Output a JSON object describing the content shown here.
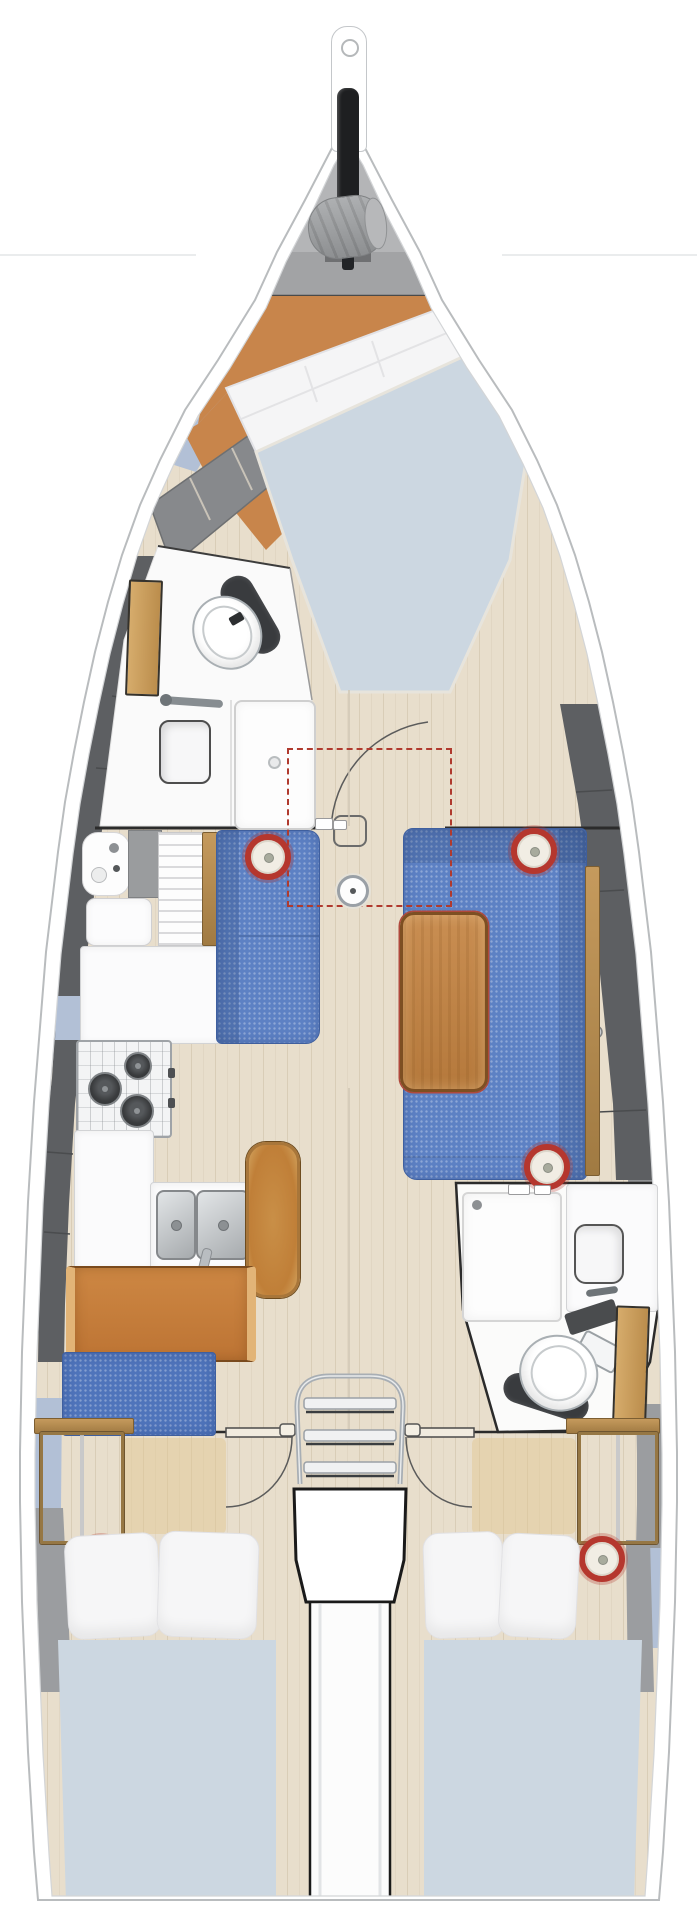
{
  "diagram": {
    "title": "Sailing yacht interior layout plan, top-down, bow up",
    "orientation": "bow-up",
    "areas": [
      {
        "id": "bow-locker",
        "label": "Bow anchor and sail locker",
        "items": [
          "bow sprit",
          "anchor windlass",
          "sail bag"
        ]
      },
      {
        "id": "forward-cabin",
        "label": "Forward owner cabin",
        "items": [
          "angled double berth",
          "pillows",
          "duvet",
          "orange wood floor",
          "shelf lockers"
        ]
      },
      {
        "id": "forward-head",
        "label": "Forward head (port)",
        "items": [
          "toilet",
          "sink",
          "faucet",
          "shower stall",
          "wood door"
        ]
      },
      {
        "id": "saloon",
        "label": "Saloon",
        "items": [
          "port settee",
          "starboard U-shaped sofa",
          "wood dining table",
          "folding table leaf shown dashed",
          "mast post",
          "door swing arc"
        ]
      },
      {
        "id": "galley",
        "label": "Galley (port)",
        "items": [
          "utility sink",
          "fridge lid",
          "slatted locker",
          "worktop",
          "three-burner gimbaled stove",
          "double stainless sink with faucet"
        ]
      },
      {
        "id": "nav-station",
        "label": "Navigation station (port)",
        "items": [
          "chart desk",
          "seat backrest",
          "blue bench"
        ]
      },
      {
        "id": "companionway",
        "label": "Companionway",
        "items": [
          "three-step chrome ladder",
          "engine box",
          "center engine tunnel"
        ]
      },
      {
        "id": "aft-head",
        "label": "Aft head (starboard)",
        "items": [
          "shower stall",
          "sink with counter",
          "toilet",
          "wood door",
          "dark shelf"
        ]
      },
      {
        "id": "aft-cabin-port",
        "label": "Aft cabin port",
        "items": [
          "double berth",
          "two pillows",
          "clothes locker",
          "ceiling speaker",
          "door swing arc"
        ]
      },
      {
        "id": "aft-cabin-starboard",
        "label": "Aft cabin starboard",
        "items": [
          "double berth",
          "two pillows",
          "clothes locker",
          "ceiling speaker",
          "door swing arc"
        ]
      }
    ],
    "counts": {
      "cabins": 3,
      "heads": 2,
      "speakers": 5,
      "stove_burners": 3,
      "ladder_steps": 3,
      "sinks": 5
    }
  },
  "colors": {
    "hull_stroke": "#b9bcbe",
    "inner_line": "#d3d5d7",
    "floor": "#e8decc",
    "floor_stripe": "#d9cdb7",
    "orange": "#c8854b",
    "orange_dark": "#a56a32",
    "mattress": "#ccd7e1",
    "pillow": "#f5f5f6",
    "sofa": "#5d81c4",
    "sofa_dark": "#3f5f9e",
    "table": "#c08248",
    "table_edge": "#7d4f22",
    "desk": "#c8803d",
    "desk_rail": "#e2b477",
    "bench": "#4f74bb",
    "band_blue": "#b2c0d6",
    "gray_dark": "#5d5f62",
    "gray_mid": "#a9aaac",
    "gray_panel": "#88898c",
    "gray_band": "#9b9da0",
    "speaker_red": "#b5372e",
    "steel": "#aeb2b6",
    "wood_door": "#c79c5e",
    "line_dark": "#2b2b2b",
    "counter": "#fbfbfc",
    "red_dash": "#b03a2e",
    "chrome": "#a8aeb4"
  }
}
